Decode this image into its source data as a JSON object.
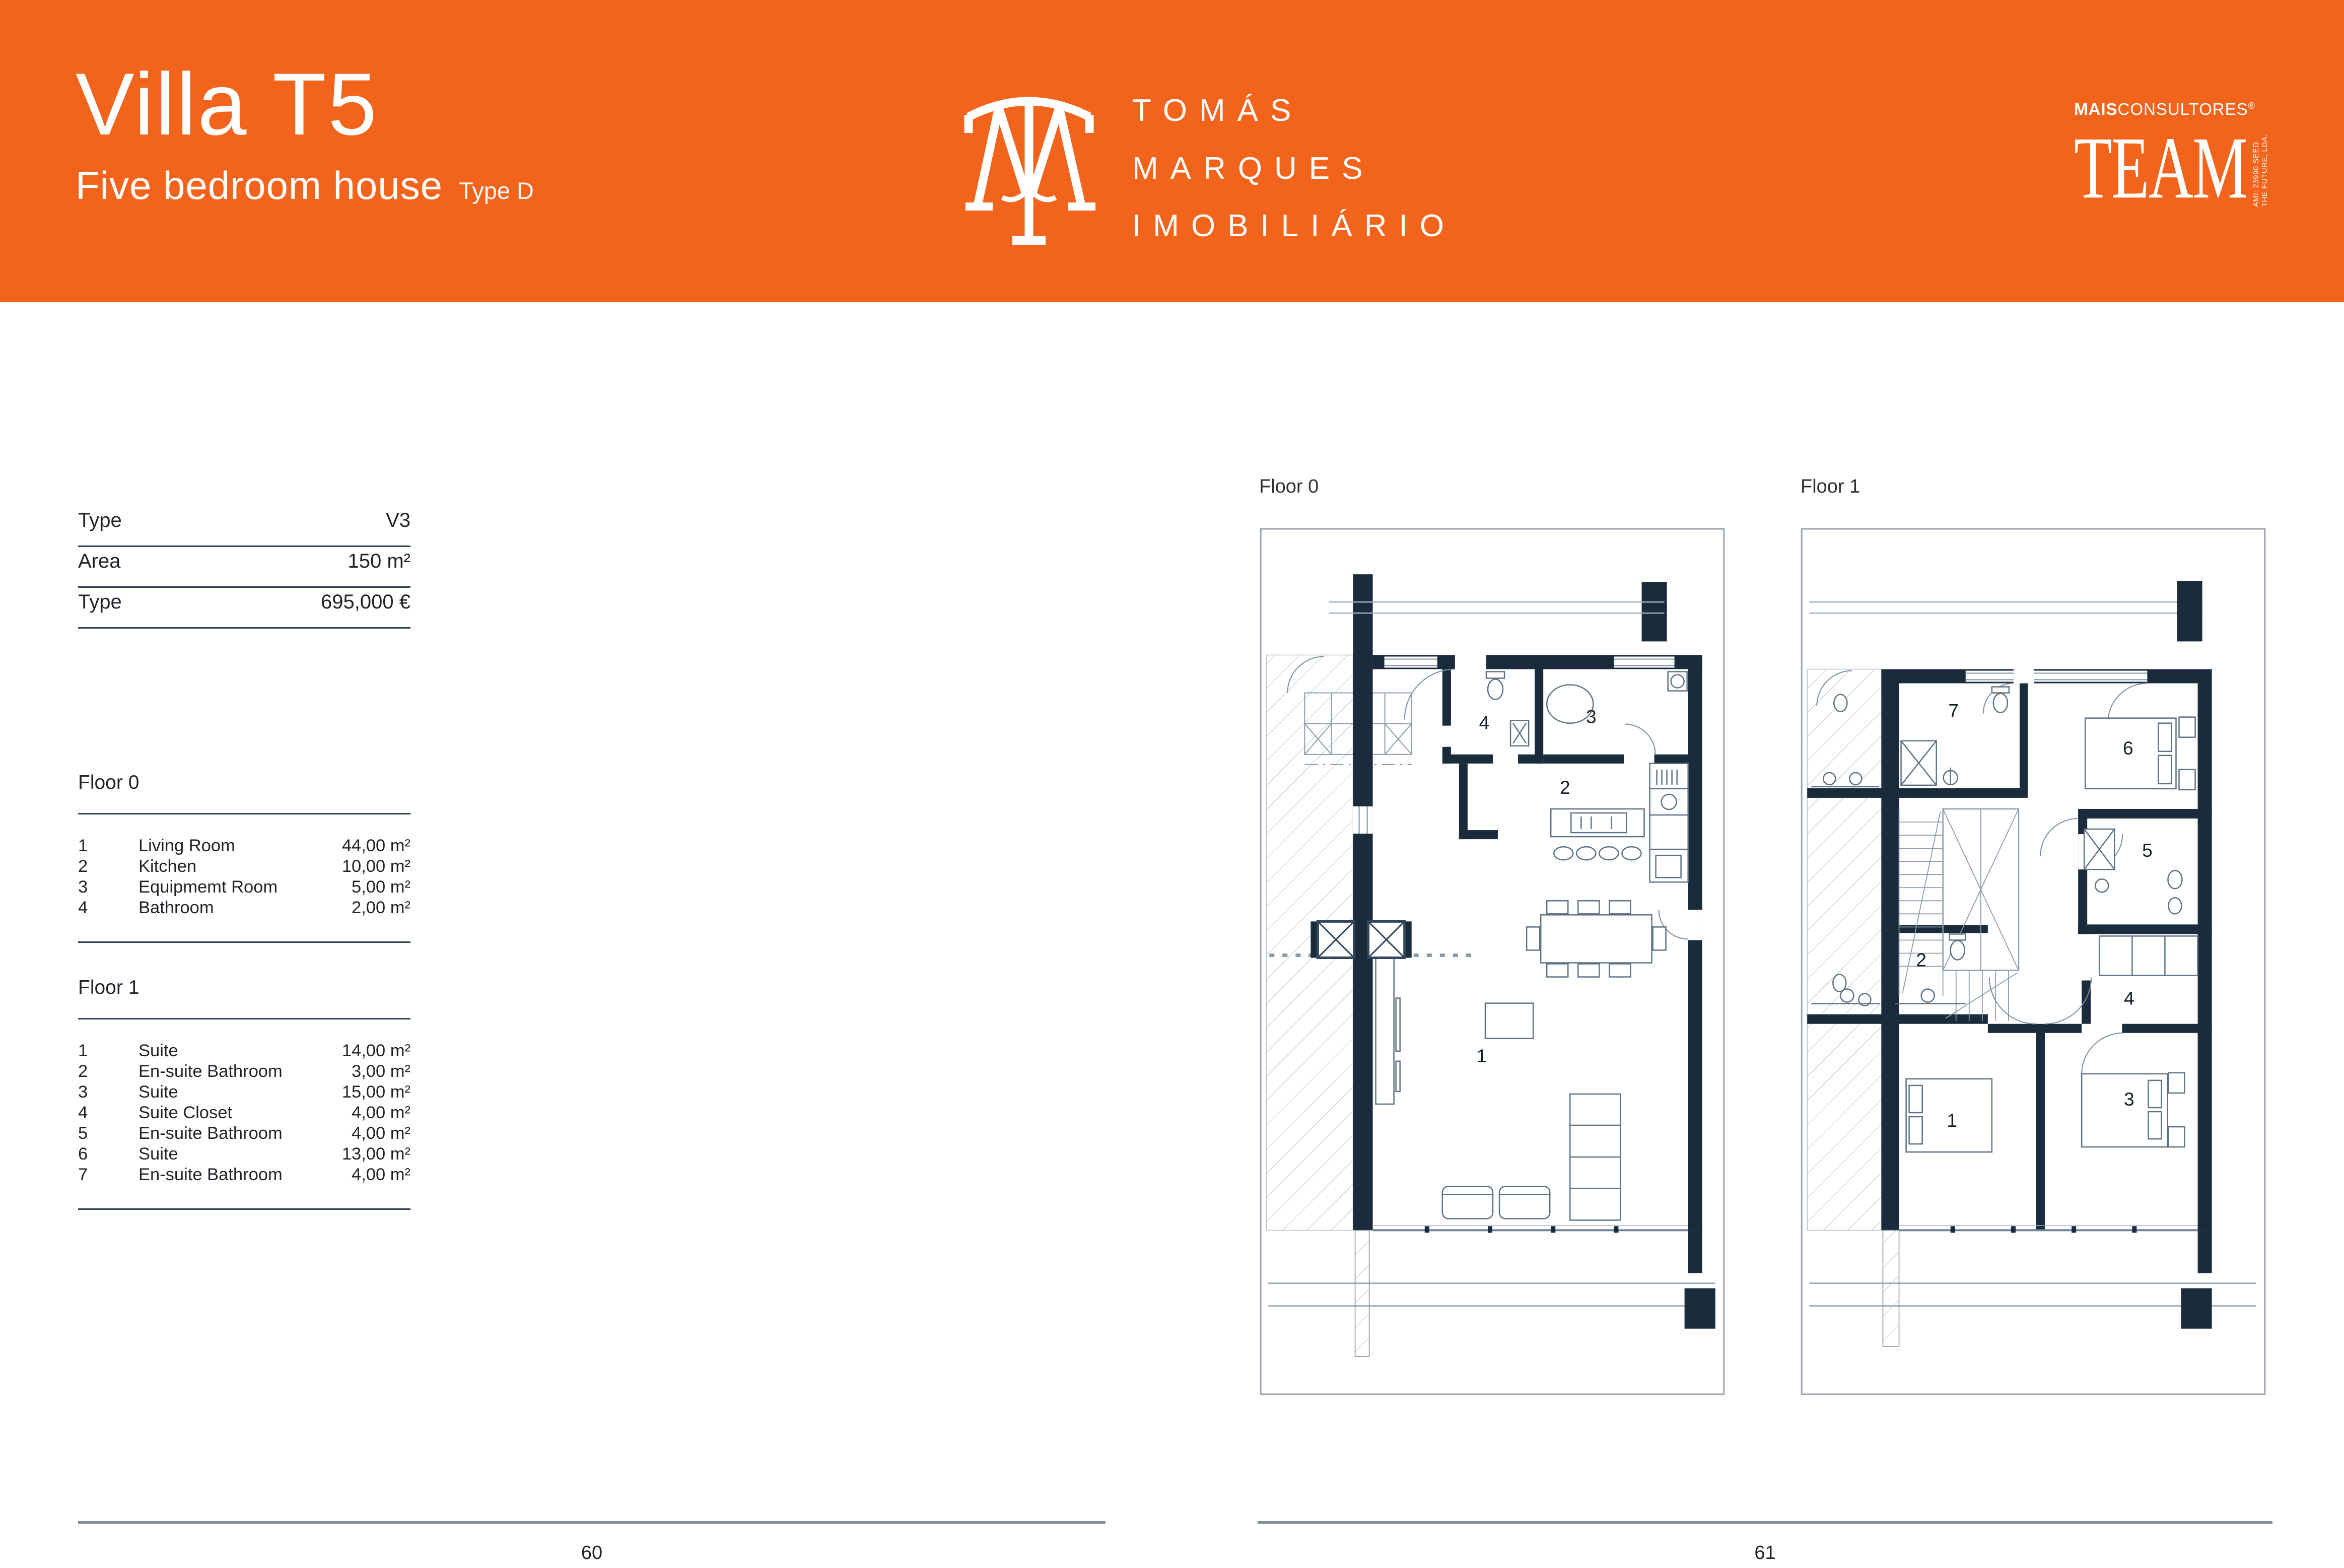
{
  "header": {
    "title": "Villa T5",
    "subtitle": "Five bedroom house",
    "type_label": "Type D",
    "brand": {
      "line1": "TOMÁS",
      "line2": "MARQUES",
      "line3": "IMOBILIÁRIO"
    },
    "partner": {
      "prefix": "MAIS",
      "suffix": "CONSULTORES",
      "registered": "®",
      "wordmark": "TEAM",
      "side_text": "AMI: 23990  SEED THE FUTURE, LDA."
    }
  },
  "specs": {
    "rows": [
      {
        "label": "Type",
        "value": "V3"
      },
      {
        "label": "Area",
        "value": "150 m²"
      },
      {
        "label": "Type",
        "value": "695,000 €"
      }
    ]
  },
  "floors": [
    {
      "list_title": "Floor 0",
      "plan_title": "Floor 0",
      "rooms": [
        {
          "num": "1",
          "name": "Living Room",
          "area": "44,00 m²"
        },
        {
          "num": "2",
          "name": "Kitchen",
          "area": "10,00 m²"
        },
        {
          "num": "3",
          "name": "Equipmemt Room",
          "area": "5,00 m²"
        },
        {
          "num": "4",
          "name": "Bathroom",
          "area": "2,00 m²"
        }
      ]
    },
    {
      "list_title": "Floor 1",
      "plan_title": "Floor 1",
      "rooms": [
        {
          "num": "1",
          "name": "Suite",
          "area": "14,00 m²"
        },
        {
          "num": "2",
          "name": "En-suite Bathroom",
          "area": "3,00 m²"
        },
        {
          "num": "3",
          "name": "Suite",
          "area": "15,00 m²"
        },
        {
          "num": "4",
          "name": "Suite Closet",
          "area": "4,00 m²"
        },
        {
          "num": "5",
          "name": "En-suite Bathroom",
          "area": "4,00 m²"
        },
        {
          "num": "6",
          "name": "Suite",
          "area": "13,00 m²"
        },
        {
          "num": "7",
          "name": "En-suite Bathroom",
          "area": "4,00 m²"
        }
      ]
    }
  ],
  "footer": {
    "left_page": "60",
    "right_page": "61"
  },
  "colors": {
    "accent": "#F2641C",
    "wall": "#1A2B3C",
    "plan_line": "#7A8DA0",
    "rule_dark": "#2E4053",
    "rule_gray": "#7E8A95"
  }
}
